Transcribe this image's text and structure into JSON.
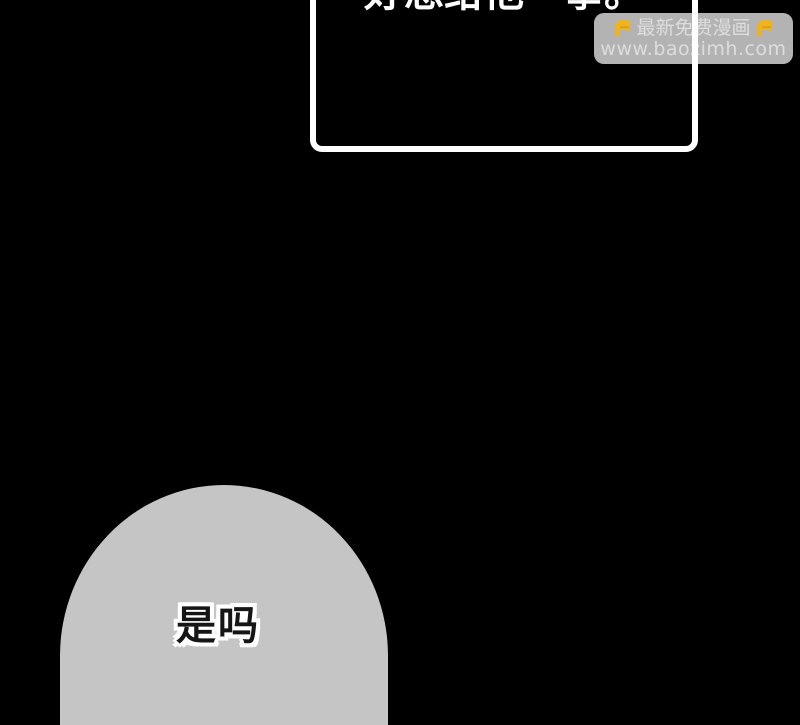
{
  "canvas": {
    "width": 800,
    "height": 625,
    "background": "#000000"
  },
  "speech_box": {
    "text": "好想给他一拳。",
    "border_color": "#ffffff",
    "text_color": "#ffffff"
  },
  "watermark": {
    "title": "最新免费漫画",
    "url": "www.baozimh.com",
    "icon": "pointing-down-hand",
    "icon_color": "#f1b31c",
    "background": "rgba(255,255,255,0.70)",
    "text_color": "rgba(255,255,255,0.55)"
  },
  "bottom_bubble": {
    "text": "是吗",
    "fill": "#c5c5c5",
    "text_color": "#161616",
    "outline_color": "#ffffff"
  }
}
